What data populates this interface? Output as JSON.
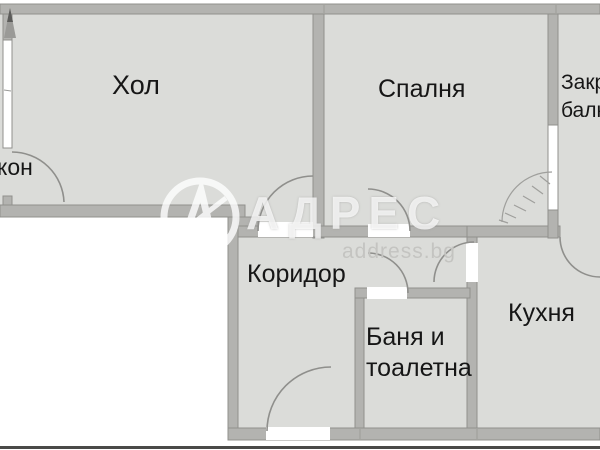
{
  "plan_title": "apartment-floor-plan",
  "rooms": {
    "hol": {
      "label": "Хол"
    },
    "spalnya": {
      "label": "Спалня"
    },
    "zakrit_balkon": {
      "line1": "Закр",
      "line2": "балк"
    },
    "balkon": {
      "label": "кон"
    },
    "koridor": {
      "label": "Коридор"
    },
    "banya": {
      "line1": "Баня и",
      "line2": "тоалетна"
    },
    "kuhnya": {
      "label": "Кухня"
    }
  },
  "watermark": {
    "brand": "АДРЕС",
    "site": "address.bg"
  },
  "colors": {
    "floor": "#dbdcd9",
    "wall": "#b3b3b0",
    "wall_edge": "#90908d",
    "window": "#ffffff",
    "gap": "#ffffff",
    "outside": "#ffffff",
    "label": "#161616",
    "arc": "#8f8f8c",
    "sketch": "#9f9f9c",
    "site_text": "#c4c4c1",
    "bottom_line": "#4a4a48"
  }
}
